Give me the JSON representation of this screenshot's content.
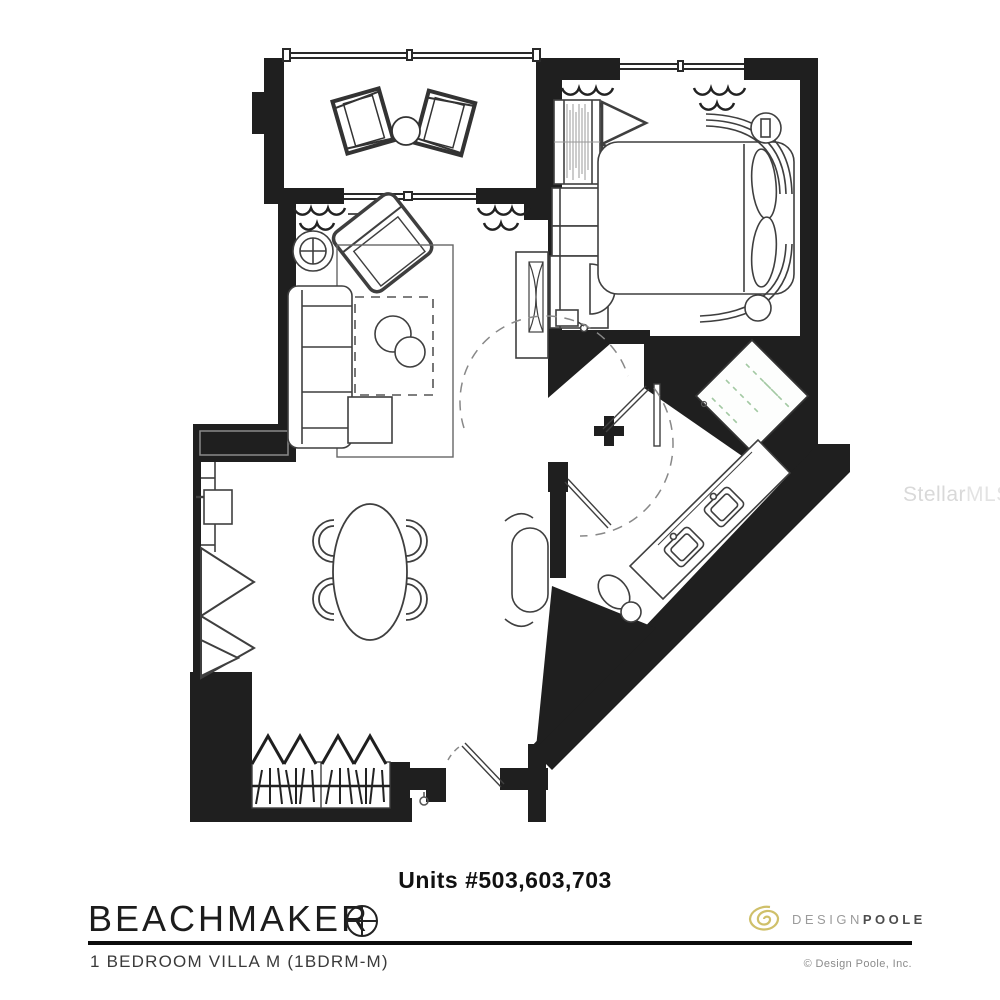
{
  "plan": {
    "units_label": "Units #503,603,703",
    "wall_color": "#1f1f1f",
    "line_color": "#3a3a3a",
    "glass_color": "#a3c9a3",
    "rooms": [
      "balcony",
      "bedroom",
      "living-room",
      "dining-area",
      "kitchenette",
      "bathroom",
      "shower",
      "entry-closet",
      "entry"
    ]
  },
  "footer": {
    "building_name": "BEACHMAKER",
    "unit_type_label": "1 BEDROOM VILLA M (1BDRM-M)",
    "compass_icon": "circled-plus-compass",
    "designer": {
      "logo_icon": "gold-spiral",
      "name_part1": "DESIGN",
      "name_part2": "POOLE",
      "copyright": "© Design Poole, Inc.",
      "spiral_color": "#cfc06a"
    }
  },
  "watermark": {
    "part1": "Stellar",
    "part2": "MLS"
  }
}
